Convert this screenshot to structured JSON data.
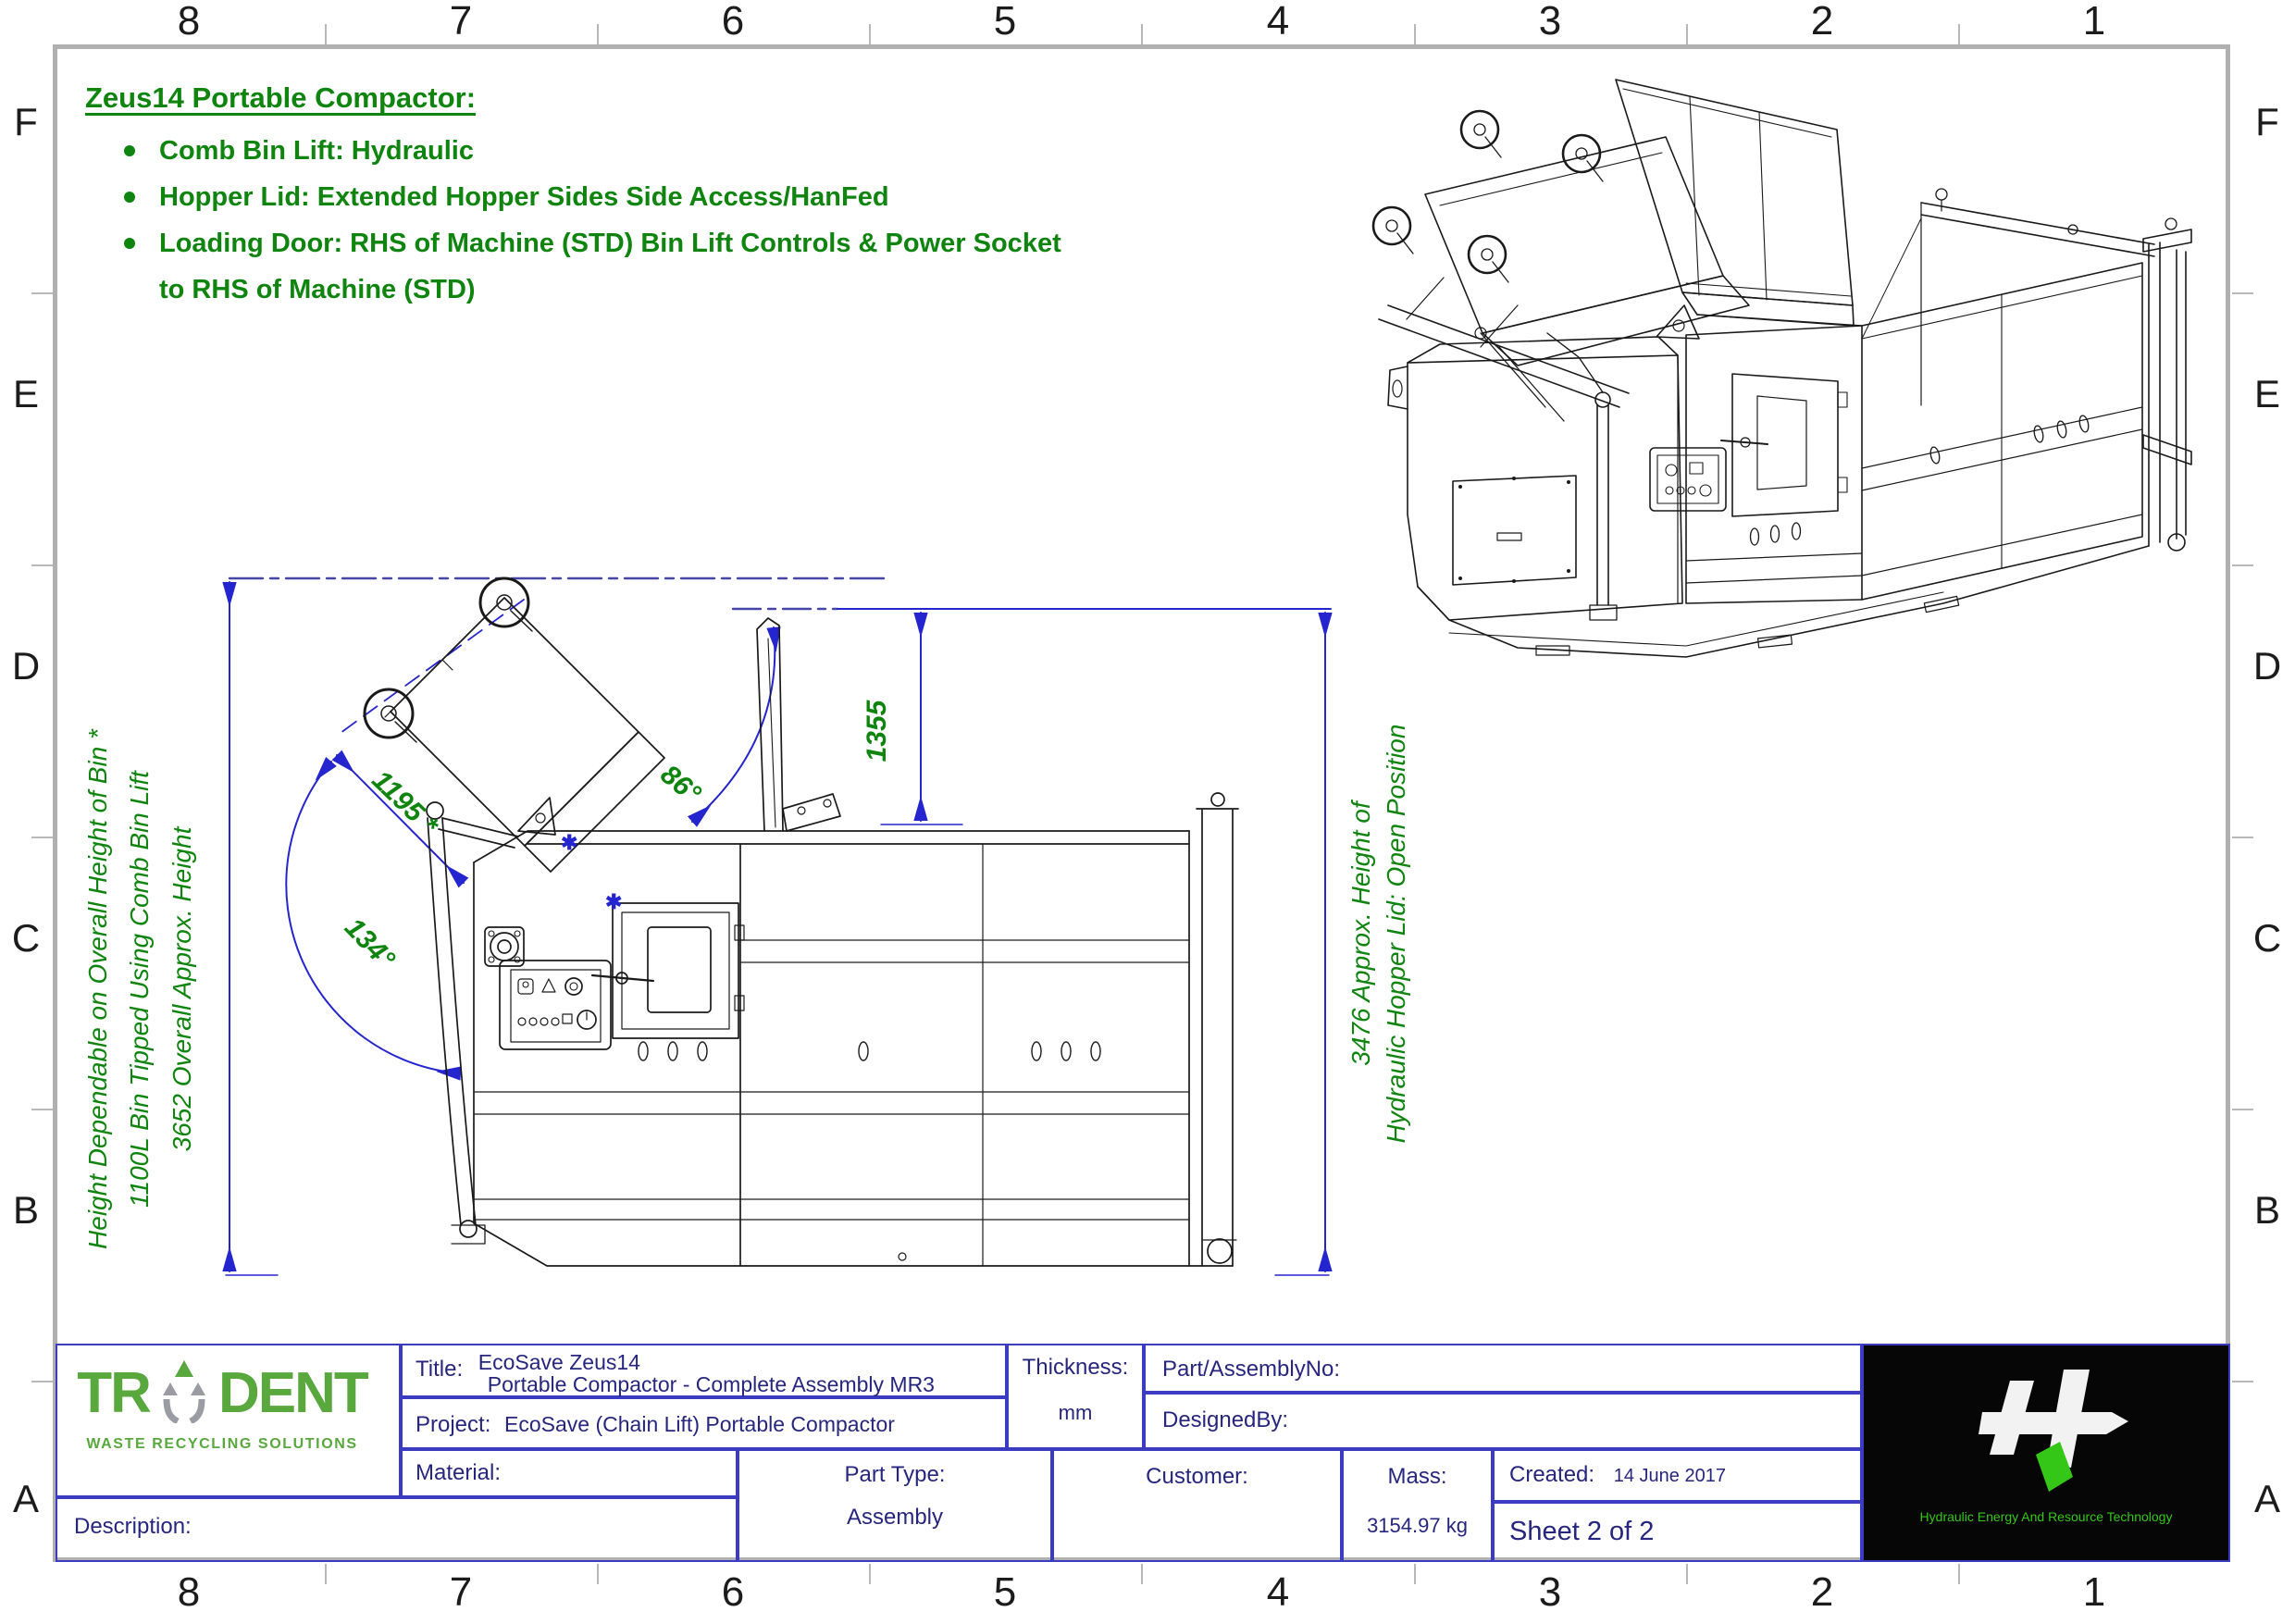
{
  "colors": {
    "annotation_green": "#0f840f",
    "dimension_blue": "#2525cf",
    "centerline_blue": "#4646a8",
    "titleblock_navy": "#26267e",
    "titleblock_line_blue": "#3c3cc3",
    "frame_gray": "#b0b0b0",
    "logo_green": "#58a83e",
    "logo_gray": "#9b9ba3",
    "hert_bg": "#060606",
    "hert_green": "#35c718"
  },
  "margin": {
    "columns": [
      "8",
      "7",
      "6",
      "5",
      "4",
      "3",
      "2",
      "1"
    ],
    "rows": [
      "F",
      "E",
      "D",
      "C",
      "B",
      "A"
    ]
  },
  "notes": {
    "heading": "Zeus14 Portable Compactor:",
    "bullets": [
      "Comb Bin Lift: Hydraulic",
      "Hopper Lid: Extended Hopper Sides Side Access/HanFed",
      "Loading Door: RHS of Machine (STD) Bin Lift Controls & Power Socket to RHS of Machine (STD)"
    ]
  },
  "side_view": {
    "dim_bin": "1195 *",
    "angle_lift": "134°",
    "angle_lid": "86°",
    "dim_lid_height": "1355",
    "left_note_1": "Height Dependable on Overall Height of Bin *",
    "left_note_2": "1100L Bin Tipped Using Comb Bin Lift",
    "left_note_3": "3652 Overall Approx. Height",
    "right_note_1": "3476 Approx. Height of",
    "right_note_2": "Hydraulic Hopper Lid: Open Position"
  },
  "title_block": {
    "title_label": "Title:",
    "title_line1": "EcoSave Zeus14",
    "title_line2": "Portable Compactor - Complete Assembly MR3",
    "project_label": "Project:",
    "project_value": "EcoSave (Chain Lift) Portable Compactor",
    "thickness_label": "Thickness:",
    "thickness_value": "mm",
    "part_no_label": "Part/AssemblyNo:",
    "designed_by_label": "DesignedBy:",
    "material_label": "Material:",
    "part_type_label": "Part Type:",
    "part_type_value": "Assembly",
    "customer_label": "Customer:",
    "mass_label": "Mass:",
    "mass_value": "3154.97 kg",
    "created_label": "Created:",
    "created_value": "14 June 2017",
    "sheet_label": "Sheet 2 of 2",
    "description_label": "Description:"
  },
  "trident_logo": {
    "part1": "TR",
    "part2": "DENT",
    "subtitle": "WASTE RECYCLING SOLUTIONS"
  },
  "hert_logo": {
    "tagline": "Hydraulic Energy And Resource Technology"
  }
}
